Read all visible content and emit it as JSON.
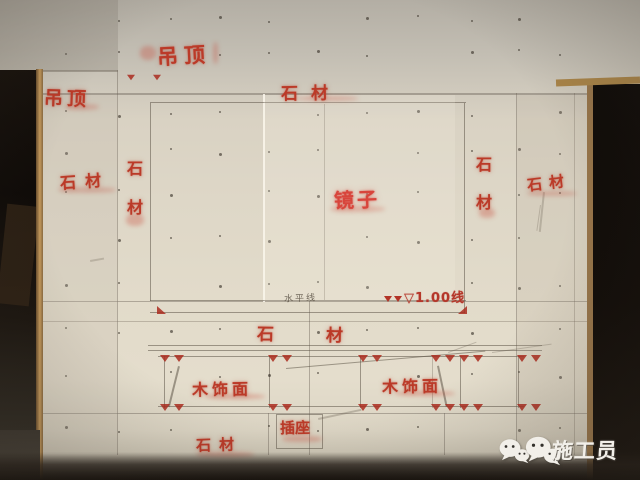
{
  "colors": {
    "stencil_red": "#bb3a28",
    "mirror_red": "#d8453c",
    "wall_light": "#ddd6c6",
    "wall_gray": "#bcb7ac",
    "pencil_gray": "#5f5648",
    "wood_trim": "#b9905a",
    "dark_opening": "#140f0a",
    "watermark_white": "#f2efe9"
  },
  "stencil_labels": [
    {
      "id": "ceiling-top",
      "text": "吊顶",
      "x": 157,
      "y": 40,
      "size": 21,
      "ls": 6,
      "rot": -3
    },
    {
      "id": "ceiling-left",
      "text": "吊顶",
      "x": 44,
      "y": 84,
      "size": 19,
      "ls": 4,
      "rot": 2
    },
    {
      "id": "stone-top",
      "text": "石材",
      "x": 281,
      "y": 79,
      "size": 17,
      "ls": 13,
      "rot": -1
    },
    {
      "id": "stone-left",
      "text": "石材",
      "x": 60,
      "y": 168,
      "size": 16,
      "ls": 9,
      "rot": -4
    },
    {
      "id": "stone-left-vertical",
      "text": "石材",
      "x": 127,
      "y": 155,
      "size": 16,
      "dir": "v",
      "gap": 15
    },
    {
      "id": "mirror",
      "text": "镜子",
      "x": 334,
      "y": 184,
      "size": 20,
      "ls": 3,
      "rot": -2,
      "variant": "bright"
    },
    {
      "id": "stone-right-vertical",
      "text": "石材",
      "x": 476,
      "y": 151,
      "size": 16,
      "dir": "v",
      "gap": 14
    },
    {
      "id": "stone-right",
      "text": "石材",
      "x": 527,
      "y": 172,
      "size": 15,
      "ls": 7,
      "rot": -7
    },
    {
      "id": "level-mark",
      "text": "▽1.00线",
      "x": 384,
      "y": 287,
      "size": 13,
      "ls": 1,
      "variant": "level"
    },
    {
      "id": "horizontal-line-note",
      "text": "水平线",
      "x": 284,
      "y": 291,
      "size": 9,
      "ls": 2,
      "rot": -2,
      "variant": "pencil"
    },
    {
      "id": "stone-middle",
      "text": "石材",
      "x": 257,
      "y": 321,
      "size": 17,
      "ls": 52,
      "rot": 1
    },
    {
      "id": "wood-veneer-left",
      "text": "木饰面",
      "x": 192,
      "y": 376,
      "size": 16,
      "ls": 4,
      "rot": -1
    },
    {
      "id": "wood-veneer-right",
      "text": "木饰面",
      "x": 382,
      "y": 373,
      "size": 16,
      "ls": 4,
      "rot": -1
    },
    {
      "id": "socket",
      "text": "插座",
      "x": 280,
      "y": 417,
      "size": 15,
      "ls": 0,
      "rot": -1
    },
    {
      "id": "stone-bottom",
      "text": "石材",
      "x": 196,
      "y": 434,
      "size": 15,
      "ls": 8,
      "rot": -2
    }
  ],
  "watermark": {
    "icon": "wechat-icon",
    "text": "施工员"
  }
}
